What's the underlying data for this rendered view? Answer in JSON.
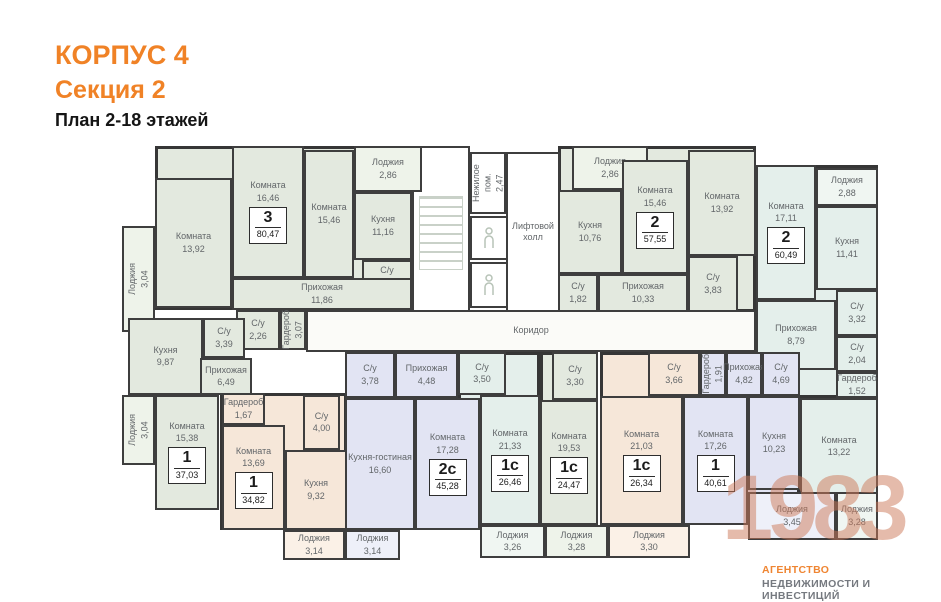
{
  "header": {
    "building": "КОРПУС 4",
    "section": "Секция 2",
    "plan_title": "План 2-18 этажей"
  },
  "watermark": {
    "year": "1983",
    "agency_line1": "АГЕНТСТВО",
    "agency_line2": "НЕДВИЖИМОСТИ И ИНВЕСТИЦИЙ"
  },
  "palette": {
    "wall": "#3e3e3e",
    "accent_orange": "#f08226",
    "watermark": "#cb7757"
  },
  "plan": {
    "common": [
      {
        "name": "corridor",
        "label": "Коридор",
        "x": 306,
        "y": 310,
        "w": 450,
        "h": 42,
        "fill": "#fbfbf8"
      },
      {
        "name": "stairwell",
        "label": "",
        "x": 412,
        "y": 146,
        "w": 58,
        "h": 166,
        "fill": "#ffffff",
        "stairs": true
      },
      {
        "name": "non-residential-room",
        "label": "Нежилое пом.",
        "area": "2,47",
        "x": 470,
        "y": 152,
        "w": 36,
        "h": 62,
        "fill": "#ffffff",
        "vert": true
      },
      {
        "name": "elevator",
        "label": "",
        "x": 470,
        "y": 216,
        "w": 38,
        "h": 44,
        "fill": "#ffffff",
        "person": true
      },
      {
        "name": "elevator",
        "label": "",
        "x": 470,
        "y": 262,
        "w": 38,
        "h": 46,
        "fill": "#ffffff",
        "person": true
      },
      {
        "name": "lift-hall",
        "label": "Лифтовой холл",
        "x": 506,
        "y": 152,
        "w": 54,
        "h": 160,
        "fill": "#ffffff"
      }
    ],
    "apartments": [
      {
        "id": "apt-3-8047",
        "type": "3",
        "total": "80,47",
        "fill": "#e3e9df",
        "loggia_fill": "#eef3ea",
        "base": {
          "x": 155,
          "y": 146,
          "w": 257,
          "h": 164
        },
        "rooms": [
          {
            "label": "Лоджия",
            "area": "3,04",
            "x": 122,
            "y": 226,
            "w": 33,
            "h": 106,
            "loggia": true,
            "vert": true
          },
          {
            "label": "Комната",
            "area": "13,92",
            "x": 155,
            "y": 178,
            "w": 77,
            "h": 130
          },
          {
            "label": "Комната",
            "area": "16,46",
            "x": 232,
            "y": 146,
            "w": 72,
            "h": 132,
            "badge": true
          },
          {
            "label": "Комната",
            "area": "15,46",
            "x": 304,
            "y": 150,
            "w": 50,
            "h": 128
          },
          {
            "label": "Лоджия",
            "area": "2,86",
            "x": 354,
            "y": 146,
            "w": 68,
            "h": 46,
            "loggia": true
          },
          {
            "label": "Кухня",
            "area": "11,16",
            "x": 354,
            "y": 192,
            "w": 58,
            "h": 68
          },
          {
            "label": "С/у",
            "area": "3,33",
            "x": 362,
            "y": 260,
            "w": 50,
            "h": 34
          },
          {
            "label": "Прихожая",
            "area": "11,86",
            "x": 232,
            "y": 278,
            "w": 180,
            "h": 32
          },
          {
            "label": "С/у",
            "area": "2,26",
            "x": 236,
            "y": 310,
            "w": 44,
            "h": 40
          },
          {
            "label": "Гардероб",
            "area": "3,07",
            "x": 280,
            "y": 310,
            "w": 26,
            "h": 40,
            "vert": true
          }
        ]
      },
      {
        "id": "apt-2-5755",
        "type": "2",
        "total": "57,55",
        "fill": "#e3e9df",
        "loggia_fill": "#eef3ea",
        "base": {
          "x": 558,
          "y": 146,
          "w": 198,
          "h": 166
        },
        "rooms": [
          {
            "label": "Лоджия",
            "area": "2,86",
            "x": 572,
            "y": 146,
            "w": 76,
            "h": 44,
            "loggia": true
          },
          {
            "label": "Кухня",
            "area": "10,76",
            "x": 558,
            "y": 190,
            "w": 64,
            "h": 84
          },
          {
            "label": "С/у",
            "area": "1,82",
            "x": 558,
            "y": 274,
            "w": 40,
            "h": 38
          },
          {
            "label": "Прихожая",
            "area": "10,33",
            "x": 598,
            "y": 274,
            "w": 90,
            "h": 38
          },
          {
            "label": "Комната",
            "area": "15,46",
            "x": 622,
            "y": 160,
            "w": 66,
            "h": 114,
            "badge": true
          },
          {
            "label": "Комната",
            "area": "13,92",
            "x": 688,
            "y": 150,
            "w": 68,
            "h": 106
          },
          {
            "label": "С/у",
            "area": "3,83",
            "x": 688,
            "y": 256,
            "w": 50,
            "h": 56
          }
        ]
      },
      {
        "id": "apt-2-6049",
        "type": "2",
        "total": "60,49",
        "fill": "#e4efeb",
        "loggia_fill": "#f0f6f2",
        "base": {
          "x": 756,
          "y": 165,
          "w": 122,
          "h": 233
        },
        "rooms": [
          {
            "label": "Комната",
            "area": "17,11",
            "x": 756,
            "y": 165,
            "w": 60,
            "h": 135,
            "badge": true
          },
          {
            "label": "Лоджия",
            "area": "2,88",
            "x": 816,
            "y": 168,
            "w": 62,
            "h": 38,
            "loggia": true
          },
          {
            "label": "Кухня",
            "area": "11,41",
            "x": 816,
            "y": 206,
            "w": 62,
            "h": 84
          },
          {
            "label": "С/у",
            "area": "3,32",
            "x": 836,
            "y": 290,
            "w": 42,
            "h": 46
          },
          {
            "label": "С/у",
            "area": "2,04",
            "x": 836,
            "y": 336,
            "w": 42,
            "h": 36
          },
          {
            "label": "Гардероб",
            "area": "1,52",
            "x": 836,
            "y": 372,
            "w": 42,
            "h": 26
          },
          {
            "label": "Прихожая",
            "area": "8,79",
            "x": 756,
            "y": 300,
            "w": 80,
            "h": 70
          },
          {
            "label": "Комната",
            "area": "13,22",
            "x": 800,
            "y": 398,
            "w": 78,
            "h": 97
          },
          {
            "label": "Лоджия",
            "area": "3,28",
            "x": 836,
            "y": 492,
            "w": 42,
            "h": 48,
            "loggia": true
          }
        ]
      },
      {
        "id": "apt-1-4061",
        "type": "1",
        "total": "40,61",
        "fill": "#e2e4f3",
        "loggia_fill": "#eef0f9",
        "base": {
          "x": 683,
          "y": 352,
          "w": 117,
          "h": 173
        },
        "rooms": [
          {
            "label": "Гардероб",
            "area": "1,91",
            "x": 700,
            "y": 352,
            "w": 26,
            "h": 44,
            "vert": true
          },
          {
            "label": "Прихожая",
            "area": "4,82",
            "x": 726,
            "y": 352,
            "w": 36,
            "h": 44
          },
          {
            "label": "С/у",
            "area": "4,69",
            "x": 762,
            "y": 352,
            "w": 38,
            "h": 44
          },
          {
            "label": "Комната",
            "area": "17,26",
            "x": 683,
            "y": 396,
            "w": 65,
            "h": 129,
            "badge": true
          },
          {
            "label": "Кухня",
            "area": "10,23",
            "x": 748,
            "y": 396,
            "w": 52,
            "h": 94
          },
          {
            "label": "Лоджия",
            "area": "3,45",
            "x": 748,
            "y": 492,
            "w": 88,
            "h": 48,
            "loggia": true
          }
        ]
      },
      {
        "id": "apt-1s-2634",
        "type": "1с",
        "total": "26,34",
        "fill": "#f6e7d9",
        "loggia_fill": "#fbf1e7",
        "base": {
          "x": 600,
          "y": 352,
          "w": 83,
          "h": 173
        },
        "rooms": [
          {
            "label": "С/у",
            "area": "3,66",
            "x": 648,
            "y": 352,
            "w": 52,
            "h": 44
          },
          {
            "label": "Комната",
            "area": "21,03",
            "x": 600,
            "y": 396,
            "w": 83,
            "h": 129,
            "badge": true
          },
          {
            "label": "Лоджия",
            "area": "3,30",
            "x": 608,
            "y": 525,
            "w": 82,
            "h": 33,
            "loggia": true
          }
        ]
      },
      {
        "id": "apt-1s-2447",
        "type": "1с",
        "total": "24,47",
        "fill": "#e3e9df",
        "loggia_fill": "#eef3ea",
        "base": {
          "x": 540,
          "y": 352,
          "w": 58,
          "h": 173
        },
        "rooms": [
          {
            "label": "С/у",
            "area": "3,30",
            "x": 552,
            "y": 352,
            "w": 46,
            "h": 48
          },
          {
            "label": "Комната",
            "area": "19,53",
            "x": 540,
            "y": 400,
            "w": 58,
            "h": 125,
            "badge": true
          },
          {
            "label": "Лоджия",
            "area": "3,28",
            "x": 545,
            "y": 525,
            "w": 63,
            "h": 33,
            "loggia": true
          }
        ]
      },
      {
        "id": "apt-1s-2646",
        "type": "1с",
        "total": "26,46",
        "fill": "#e4efeb",
        "loggia_fill": "#f0f6f2",
        "base": {
          "x": 458,
          "y": 352,
          "w": 82,
          "h": 173
        },
        "rooms": [
          {
            "label": "С/у",
            "area": "3,50",
            "x": 458,
            "y": 352,
            "w": 48,
            "h": 43
          },
          {
            "label": "Комната",
            "area": "21,33",
            "x": 480,
            "y": 395,
            "w": 60,
            "h": 130,
            "badge": true
          },
          {
            "label": "Лоджия",
            "area": "3,26",
            "x": 480,
            "y": 525,
            "w": 65,
            "h": 33,
            "loggia": true
          }
        ]
      },
      {
        "id": "apt-2s-4528",
        "type": "2с",
        "total": "45,28",
        "fill": "#e2e4f3",
        "loggia_fill": "#eef0f9",
        "base": {
          "x": 345,
          "y": 352,
          "w": 113,
          "h": 178
        },
        "rooms": [
          {
            "label": "С/у",
            "area": "3,78",
            "x": 345,
            "y": 352,
            "w": 50,
            "h": 46
          },
          {
            "label": "Прихожая",
            "area": "4,48",
            "x": 395,
            "y": 352,
            "w": 63,
            "h": 46
          },
          {
            "label": "Кухня-гостиная",
            "area": "16,60",
            "x": 345,
            "y": 398,
            "w": 70,
            "h": 132
          },
          {
            "label": "Комната",
            "area": "17,28",
            "x": 415,
            "y": 398,
            "w": 65,
            "h": 132,
            "badge": true
          },
          {
            "label": "Лоджия",
            "area": "3,14",
            "x": 345,
            "y": 530,
            "w": 55,
            "h": 30,
            "loggia": true
          }
        ]
      },
      {
        "id": "apt-1-3482",
        "type": "1",
        "total": "34,82",
        "fill": "#f6e7d9",
        "loggia_fill": "#fbf1e7",
        "base": {
          "x": 220,
          "y": 393,
          "w": 127,
          "h": 137
        },
        "rooms": [
          {
            "label": "Гардероб",
            "area": "1,67",
            "x": 222,
            "y": 393,
            "w": 43,
            "h": 32
          },
          {
            "label": "Комната",
            "area": "13,69",
            "x": 222,
            "y": 425,
            "w": 63,
            "h": 105,
            "badge": true
          },
          {
            "label": "С/у",
            "area": "4,00",
            "x": 303,
            "y": 395,
            "w": 37,
            "h": 55
          },
          {
            "label": "Кухня",
            "area": "9,32",
            "x": 285,
            "y": 450,
            "w": 62,
            "h": 80
          },
          {
            "label": "Лоджия",
            "area": "3,14",
            "x": 283,
            "y": 530,
            "w": 62,
            "h": 30,
            "loggia": true
          }
        ]
      },
      {
        "id": "apt-1-3703",
        "type": "1",
        "total": "37,03",
        "fill": "#e3e9df",
        "loggia_fill": "#eef3ea",
        "base": {
          "x": 128,
          "y": 318,
          "w": 117,
          "h": 77
        },
        "rooms": [
          {
            "label": "Кухня",
            "area": "9,87",
            "x": 128,
            "y": 318,
            "w": 75,
            "h": 77
          },
          {
            "label": "С/у",
            "area": "3,39",
            "x": 203,
            "y": 318,
            "w": 42,
            "h": 40
          },
          {
            "label": "Прихожая",
            "area": "6,49",
            "x": 200,
            "y": 358,
            "w": 52,
            "h": 37
          },
          {
            "label": "Комната",
            "area": "15,38",
            "x": 155,
            "y": 395,
            "w": 64,
            "h": 115,
            "badge": true
          },
          {
            "label": "Лоджия",
            "area": "3,04",
            "x": 122,
            "y": 395,
            "w": 33,
            "h": 70,
            "loggia": true,
            "vert": true
          }
        ]
      }
    ]
  }
}
